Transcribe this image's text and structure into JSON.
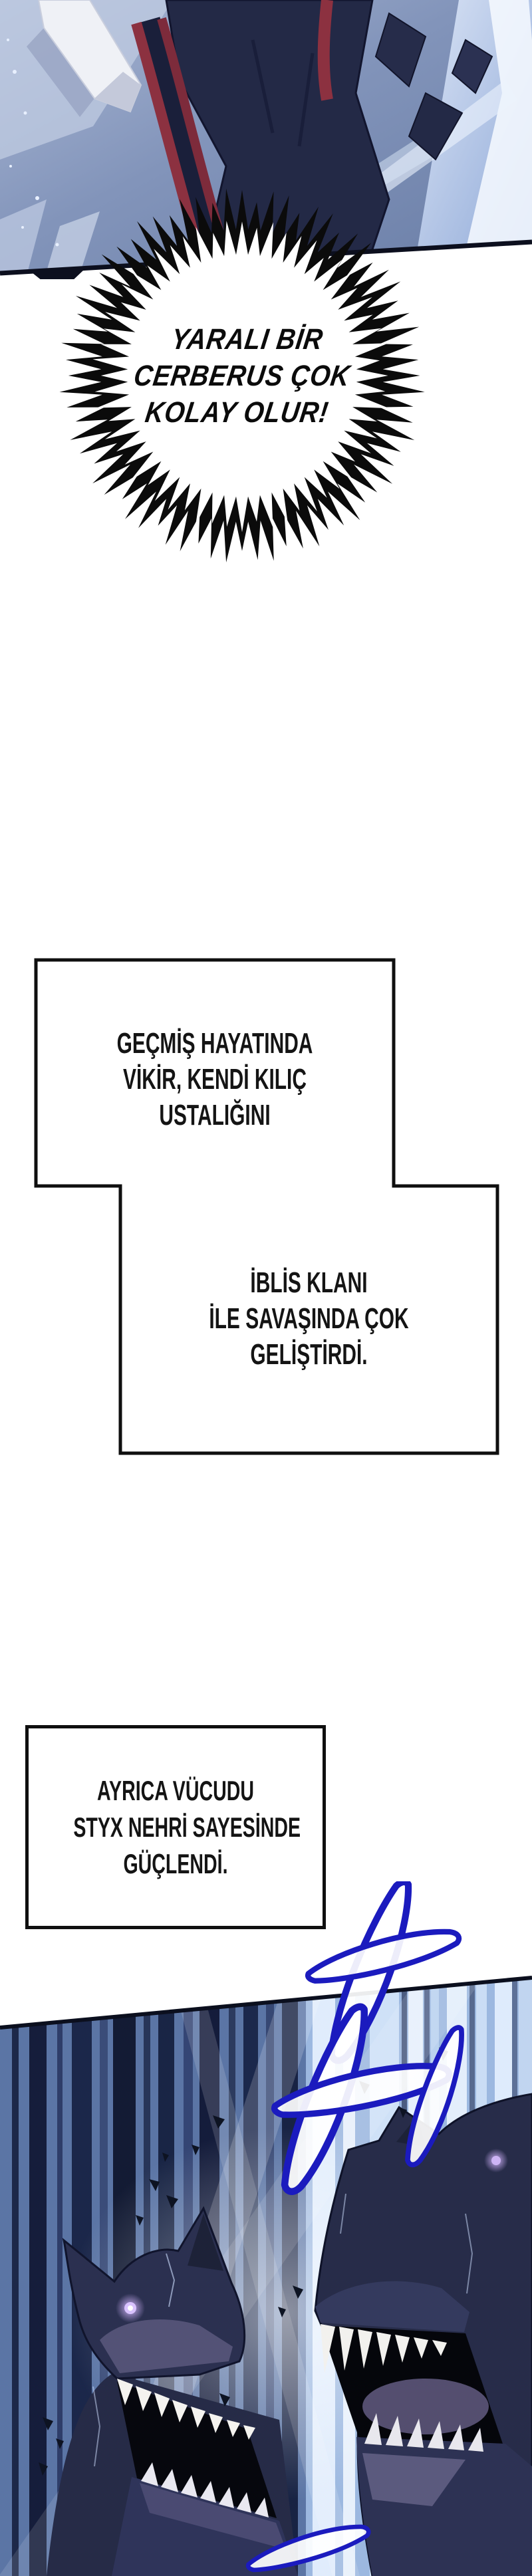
{
  "bubble": {
    "lines": [
      "YARALI BİR",
      "CERBERUS ÇOK",
      "KOLAY OLUR!"
    ]
  },
  "captions": {
    "c1": {
      "lines": [
        "GEÇMİŞ HAYATINDA",
        "VİKİR, KENDİ KILIÇ",
        "USTALIĞINI"
      ]
    },
    "c2": {
      "lines": [
        "İBLİS KLANI",
        "İLE SAVAŞINDA ÇOK",
        "GELİŞTİRDİ."
      ]
    },
    "c3": {
      "lines": [
        "AYRICA VÜCUDU",
        "STYX NEHRİ SAYESİNDE",
        "GÜÇLENDİ."
      ]
    }
  },
  "colors": {
    "ink": "#0f0f0f",
    "doodle_blue": "#1b1bbe",
    "trim_red": "#8c3140",
    "robe_navy": "#232946",
    "eye_glow": "#c9a6ff",
    "panel_steel_blue": "#8294ba",
    "deep_navy": "#16203f"
  }
}
